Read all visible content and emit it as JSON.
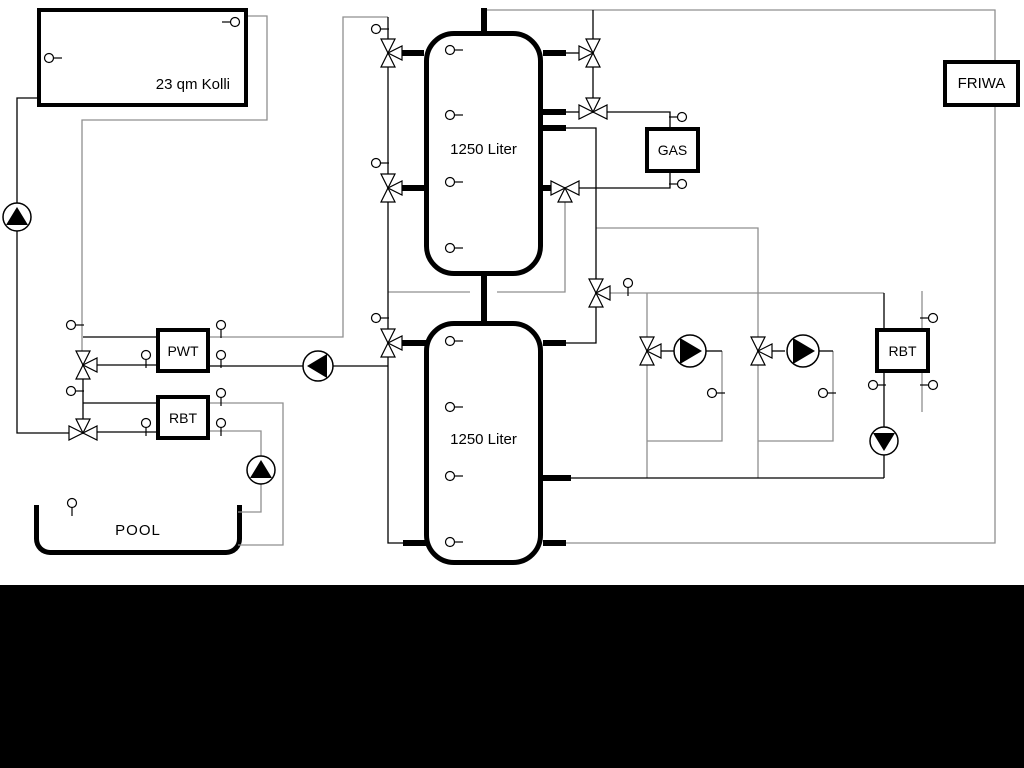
{
  "diagram_type": "hydraulic-heating-schematic",
  "labels": {
    "collector": "23 qm Kolli",
    "tank_upper": "1250 Liter",
    "tank_lower": "1250 Liter",
    "gas": "GAS",
    "friwa": "FRIWA",
    "pwt": "PWT",
    "rbt_pool": "RBT",
    "rbt_heating": "RBT",
    "pool": "POOL"
  },
  "colors": {
    "pipe": "#000000",
    "route": "#8f8f8f",
    "background": "#ffffff",
    "bottom_band": "#000000",
    "symbol_fill": "#ffffff"
  },
  "geometry": {
    "pipes": [
      [
        [
          37,
          98
        ],
        [
          17,
          98
        ],
        [
          17,
          433
        ],
        [
          69,
          433
        ]
      ],
      [
        [
          83,
          379
        ],
        [
          83,
          419
        ]
      ],
      [
        [
          83,
          337
        ],
        [
          156,
          337
        ]
      ],
      [
        [
          97,
          365
        ],
        [
          156,
          365
        ]
      ],
      [
        [
          83,
          403
        ],
        [
          156,
          403
        ]
      ],
      [
        [
          97,
          432
        ],
        [
          156,
          432
        ]
      ],
      [
        [
          210,
          366
        ],
        [
          388,
          366
        ]
      ],
      [
        [
          388,
          17
        ],
        [
          388,
          39
        ]
      ],
      [
        [
          388,
          67
        ],
        [
          388,
          174
        ]
      ],
      [
        [
          388,
          202
        ],
        [
          388,
          329
        ]
      ],
      [
        [
          388,
          357
        ],
        [
          388,
          543
        ],
        [
          404,
          543
        ]
      ],
      [
        [
          566,
          53
        ],
        [
          579,
          53
        ]
      ],
      [
        [
          593,
          10
        ],
        [
          593,
          39
        ]
      ],
      [
        [
          593,
          67
        ],
        [
          593,
          98
        ]
      ],
      [
        [
          566,
          112
        ],
        [
          579,
          112
        ]
      ],
      [
        [
          607,
          112
        ],
        [
          670,
          112
        ],
        [
          670,
          127
        ]
      ],
      [
        [
          670,
          173
        ],
        [
          670,
          188
        ],
        [
          579,
          188
        ]
      ],
      [
        [
          566,
          128
        ],
        [
          596,
          128
        ],
        [
          596,
          279
        ]
      ],
      [
        [
          596,
          307
        ],
        [
          596,
          343
        ],
        [
          565,
          343
        ]
      ],
      [
        [
          570,
          478
        ],
        [
          884,
          478
        ]
      ],
      [
        [
          884,
          293
        ],
        [
          884,
          328
        ]
      ],
      [
        [
          884,
          373
        ],
        [
          884,
          478
        ]
      ],
      [
        [
          661,
          351
        ],
        [
          674,
          351
        ]
      ],
      [
        [
          706,
          351
        ],
        [
          722,
          351
        ]
      ],
      [
        [
          772,
          351
        ],
        [
          785,
          351
        ]
      ],
      [
        [
          817,
          351
        ],
        [
          833,
          351
        ]
      ]
    ],
    "routes": [
      [
        [
          248,
          16
        ],
        [
          267,
          16
        ],
        [
          267,
          120
        ],
        [
          82,
          120
        ],
        [
          82,
          351
        ]
      ],
      [
        [
          210,
          337
        ],
        [
          343,
          337
        ],
        [
          343,
          17
        ],
        [
          388,
          17
        ]
      ],
      [
        [
          484,
          10
        ],
        [
          995,
          10
        ],
        [
          995,
          60
        ]
      ],
      [
        [
          995,
          107
        ],
        [
          995,
          543
        ],
        [
          566,
          543
        ]
      ],
      [
        [
          388,
          292
        ],
        [
          470,
          292
        ]
      ],
      [
        [
          497,
          292
        ],
        [
          565,
          292
        ],
        [
          565,
          202
        ]
      ],
      [
        [
          596,
          228
        ],
        [
          758,
          228
        ],
        [
          758,
          337
        ]
      ],
      [
        [
          610,
          293
        ],
        [
          884,
          293
        ]
      ],
      [
        [
          647,
          293
        ],
        [
          647,
          337
        ]
      ],
      [
        [
          647,
          365
        ],
        [
          647,
          478
        ]
      ],
      [
        [
          722,
          351
        ],
        [
          722,
          441
        ],
        [
          647,
          441
        ]
      ],
      [
        [
          758,
          365
        ],
        [
          758,
          478
        ]
      ],
      [
        [
          833,
          351
        ],
        [
          833,
          441
        ],
        [
          758,
          441
        ]
      ],
      [
        [
          922,
          291
        ],
        [
          922,
          328
        ]
      ],
      [
        [
          922,
          373
        ],
        [
          922,
          412
        ]
      ],
      [
        [
          210,
          403
        ],
        [
          283,
          403
        ],
        [
          283,
          545
        ],
        [
          238,
          545
        ]
      ],
      [
        [
          210,
          431
        ],
        [
          261,
          431
        ],
        [
          261,
          512
        ],
        [
          238,
          512
        ]
      ]
    ],
    "stubs": [
      [
        401,
        53,
        424,
        53
      ],
      [
        401,
        188,
        424,
        188
      ],
      [
        401,
        343,
        426,
        343
      ],
      [
        484,
        8,
        484,
        34
      ],
      [
        484,
        274,
        484,
        324
      ],
      [
        543,
        53,
        566,
        53
      ],
      [
        543,
        112,
        566,
        112
      ],
      [
        543,
        128,
        566,
        128
      ],
      [
        543,
        188,
        552,
        188
      ],
      [
        543,
        343,
        566,
        343
      ],
      [
        543,
        478,
        571,
        478
      ],
      [
        543,
        543,
        566,
        543
      ],
      [
        403,
        543,
        426,
        543
      ]
    ],
    "valves": [
      {
        "name": "valve-solar-tank1-top",
        "x": 388,
        "y": 53,
        "t": "right"
      },
      {
        "name": "valve-solar-tank1-mid",
        "x": 388,
        "y": 188,
        "t": "right"
      },
      {
        "name": "valve-solar-tank2",
        "x": 388,
        "y": 343,
        "t": "right"
      },
      {
        "name": "valve-tank1-right-top",
        "x": 593,
        "y": 53,
        "t": "left"
      },
      {
        "name": "valve-gas-supply",
        "x": 593,
        "y": 112,
        "t": "down"
      },
      {
        "name": "valve-gas-return",
        "x": 565,
        "y": 188,
        "t": "up"
      },
      {
        "name": "valve-heating-supply-selector",
        "x": 596,
        "y": 293,
        "t": "right"
      },
      {
        "name": "valve-heating-circuit-1",
        "x": 647,
        "y": 351,
        "t": "right"
      },
      {
        "name": "valve-heating-circuit-2",
        "x": 758,
        "y": 351,
        "t": "right"
      },
      {
        "name": "valve-pool-pwt",
        "x": 83,
        "y": 365,
        "t": "right"
      },
      {
        "name": "valve-pool-rbt",
        "x": 83,
        "y": 433,
        "t": "down"
      }
    ],
    "pumps": [
      {
        "name": "pump-solar",
        "x": 17,
        "y": 217,
        "r": 14,
        "dir": "up"
      },
      {
        "name": "pump-pwt",
        "x": 318,
        "y": 366,
        "r": 15,
        "dir": "left"
      },
      {
        "name": "pump-pool",
        "x": 261,
        "y": 470,
        "r": 14,
        "dir": "up"
      },
      {
        "name": "pump-heating-circuit-1",
        "x": 690,
        "y": 351,
        "r": 16,
        "dir": "right"
      },
      {
        "name": "pump-heating-circuit-2",
        "x": 803,
        "y": 351,
        "r": 16,
        "dir": "right"
      },
      {
        "name": "pump-rbt-heating",
        "x": 884,
        "y": 441,
        "r": 14,
        "dir": "down"
      }
    ],
    "sensors": [
      {
        "x": 235,
        "y": 22,
        "tick": "l"
      },
      {
        "x": 49,
        "y": 58,
        "tick": "r"
      },
      {
        "x": 450,
        "y": 50,
        "tick": "r"
      },
      {
        "x": 450,
        "y": 115,
        "tick": "r"
      },
      {
        "x": 450,
        "y": 182,
        "tick": "r"
      },
      {
        "x": 450,
        "y": 248,
        "tick": "r"
      },
      {
        "x": 450,
        "y": 341,
        "tick": "r"
      },
      {
        "x": 450,
        "y": 407,
        "tick": "r"
      },
      {
        "x": 450,
        "y": 476,
        "tick": "r"
      },
      {
        "x": 450,
        "y": 542,
        "tick": "r"
      },
      {
        "x": 376,
        "y": 29,
        "tick": "r"
      },
      {
        "x": 376,
        "y": 163,
        "tick": "r"
      },
      {
        "x": 376,
        "y": 318,
        "tick": "r"
      },
      {
        "x": 71,
        "y": 325,
        "tick": "r"
      },
      {
        "x": 146,
        "y": 355,
        "tick": "d"
      },
      {
        "x": 221,
        "y": 325,
        "tick": "d"
      },
      {
        "x": 221,
        "y": 355,
        "tick": "d"
      },
      {
        "x": 71,
        "y": 391,
        "tick": "r"
      },
      {
        "x": 146,
        "y": 423,
        "tick": "d"
      },
      {
        "x": 221,
        "y": 393,
        "tick": "d"
      },
      {
        "x": 221,
        "y": 423,
        "tick": "d"
      },
      {
        "x": 72,
        "y": 503,
        "tick": "d"
      },
      {
        "x": 682,
        "y": 117,
        "tick": "l"
      },
      {
        "x": 682,
        "y": 184,
        "tick": "l"
      },
      {
        "x": 628,
        "y": 283,
        "tick": "d"
      },
      {
        "x": 712,
        "y": 393,
        "tick": "r"
      },
      {
        "x": 823,
        "y": 393,
        "tick": "r"
      },
      {
        "x": 873,
        "y": 385,
        "tick": "r"
      },
      {
        "x": 933,
        "y": 318,
        "tick": "l"
      },
      {
        "x": 933,
        "y": 385,
        "tick": "l"
      }
    ]
  }
}
